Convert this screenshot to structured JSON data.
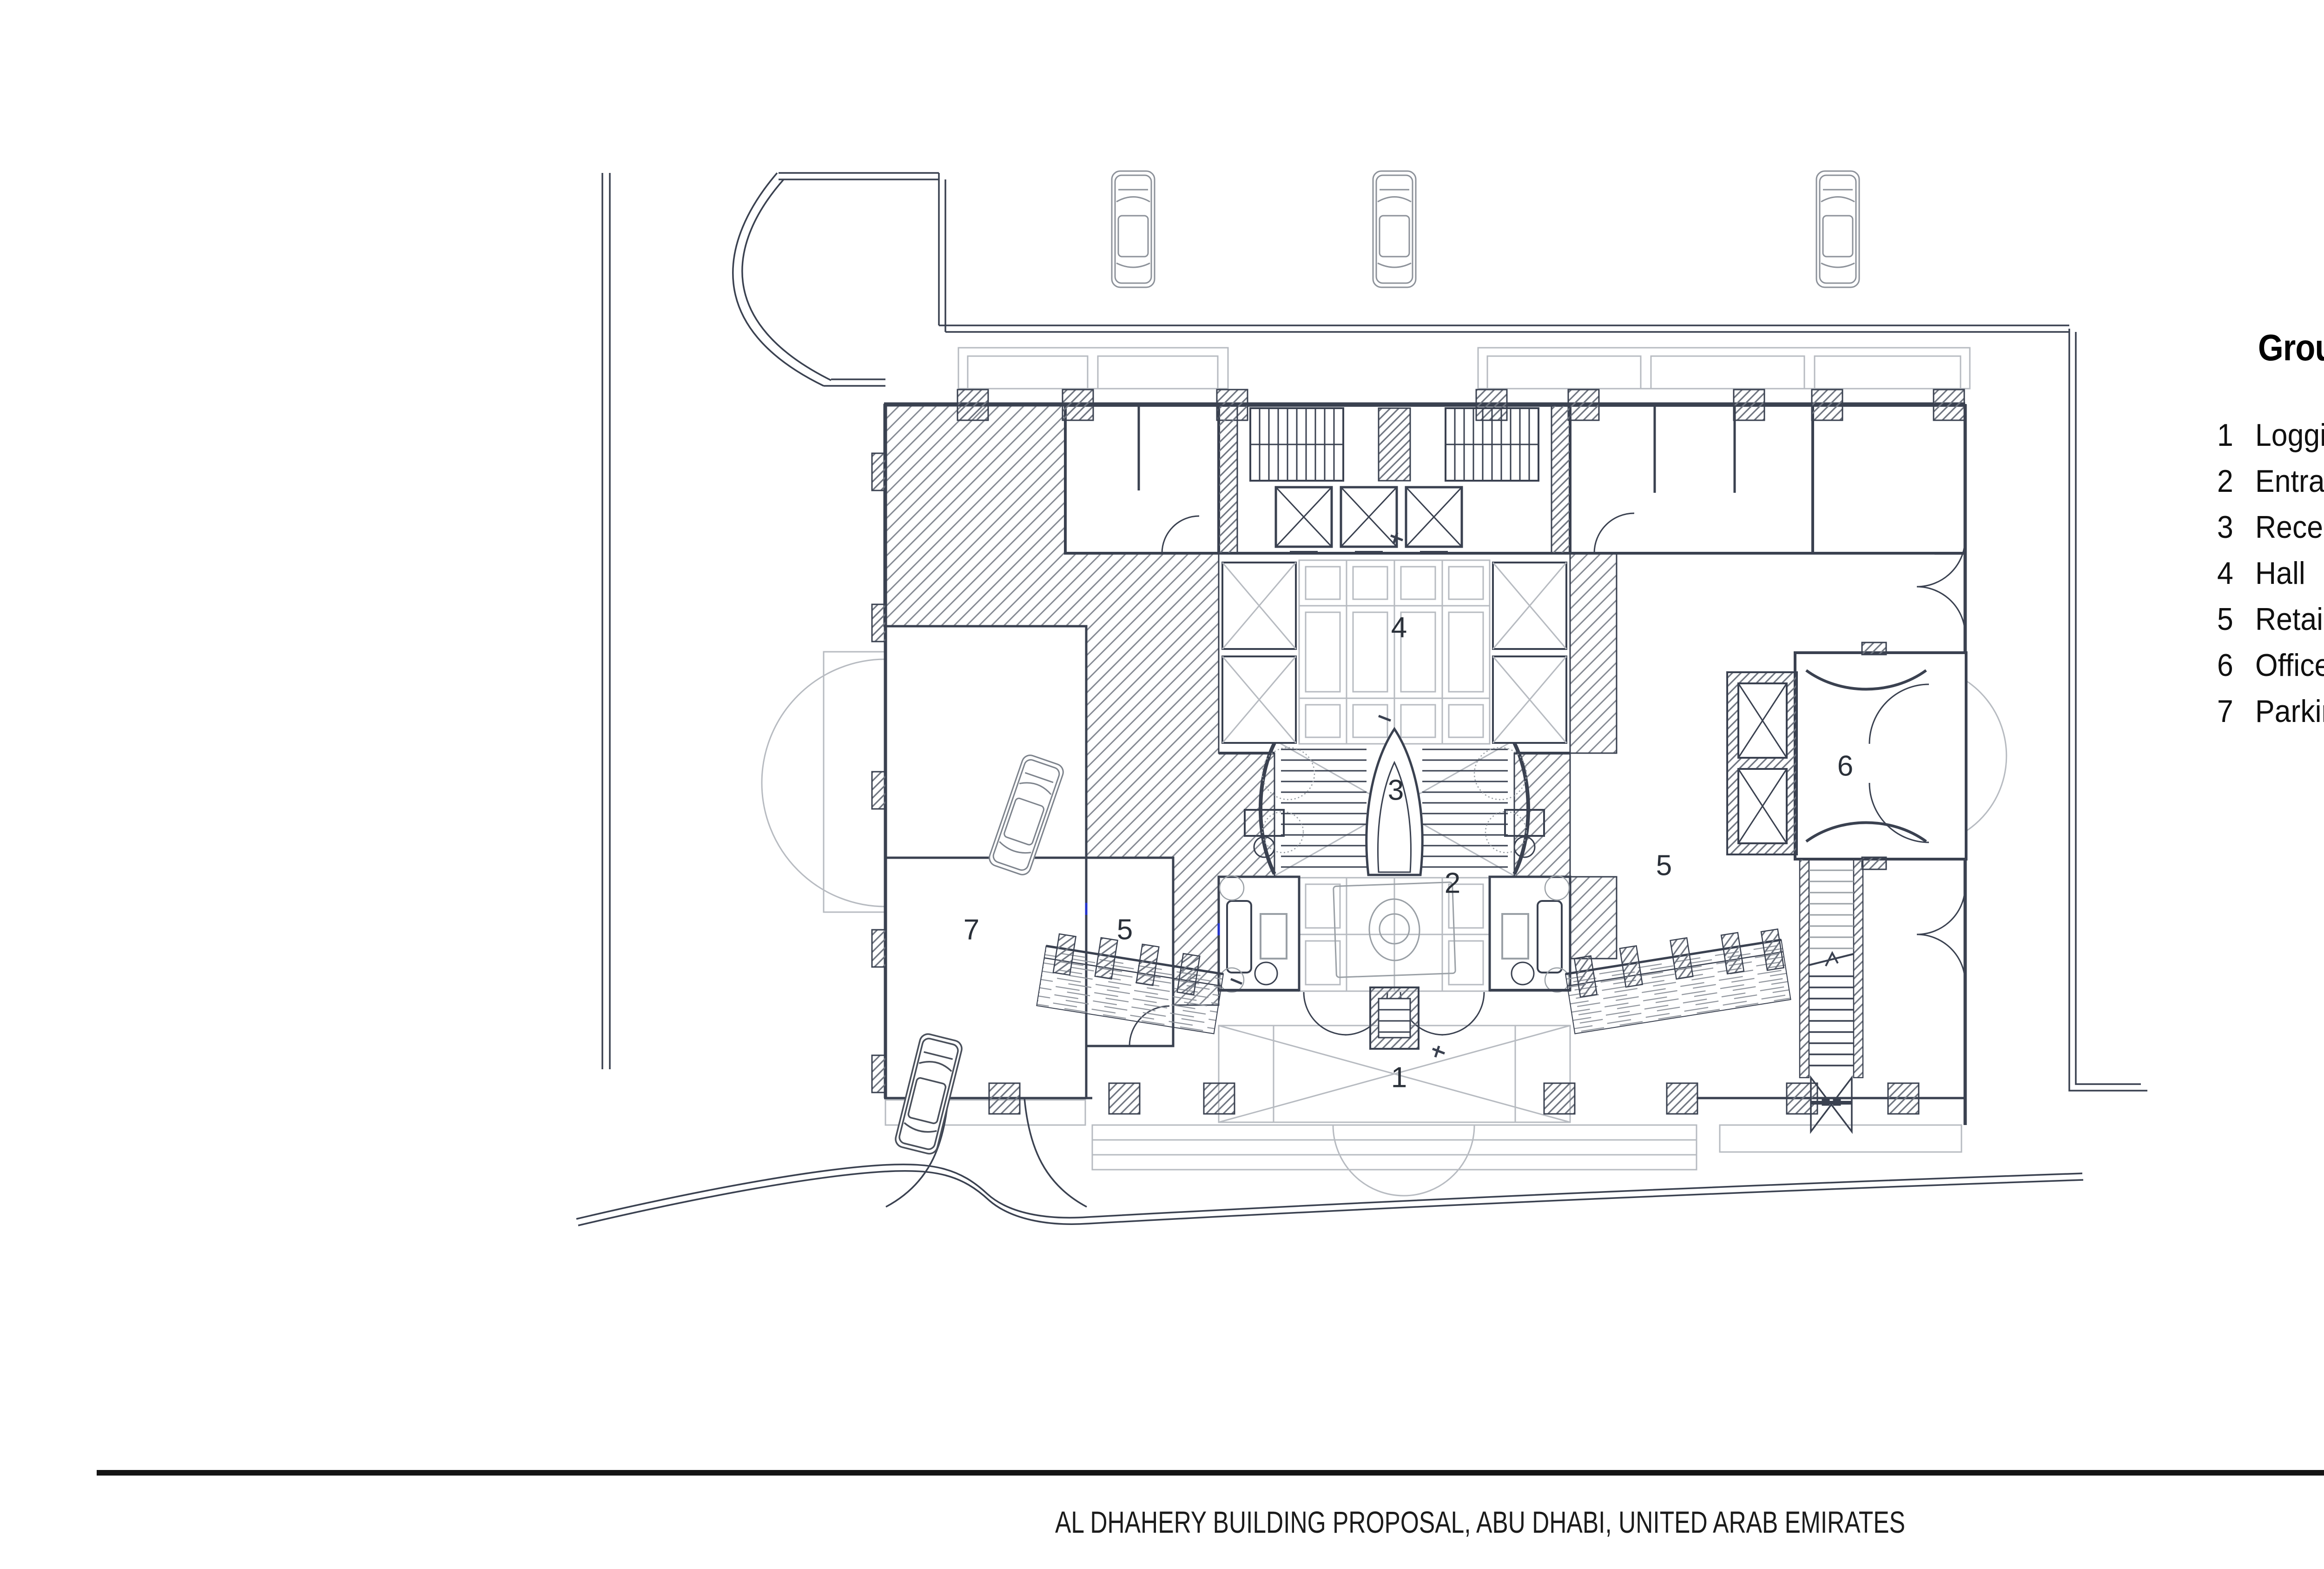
{
  "legend": {
    "title": "Ground Floor Plan",
    "items": [
      {
        "num": "1",
        "label": "Loggia"
      },
      {
        "num": "2",
        "label": "Entrance and lounge"
      },
      {
        "num": "3",
        "label": "Reception"
      },
      {
        "num": "4",
        "label": "Hall"
      },
      {
        "num": "5",
        "label": "Retail"
      },
      {
        "num": "6",
        "label": "Offices entrance"
      },
      {
        "num": "7",
        "label": "Parking entrance"
      }
    ]
  },
  "plan": {
    "labels": [
      {
        "num": "1",
        "refers_to": "Loggia"
      },
      {
        "num": "2",
        "refers_to": "Entrance and lounge"
      },
      {
        "num": "3",
        "refers_to": "Reception"
      },
      {
        "num": "4",
        "refers_to": "Hall"
      },
      {
        "num": "5",
        "refers_to": "Retail (left unit)"
      },
      {
        "num": "5",
        "refers_to": "Retail (right unit)"
      },
      {
        "num": "6",
        "refers_to": "Offices entrance"
      },
      {
        "num": "7",
        "refers_to": "Parking entrance"
      }
    ]
  },
  "footer": {
    "caption": "AL DHAHERY BUILDING PROPOSAL, ABU DHABI, UNITED ARAB EMIRATES",
    "brand": "XCASSIA"
  },
  "copyright_vertical": "© XCASSIA GLOBAL LIMITED . ALL RIGHTS RESERVED",
  "colors": {
    "drawing_line": "#3a4150",
    "hatch_gray": "#868b94",
    "light_gray": "#b7bbc1",
    "highlight_blue": "#2233cc",
    "text": "#111111"
  }
}
